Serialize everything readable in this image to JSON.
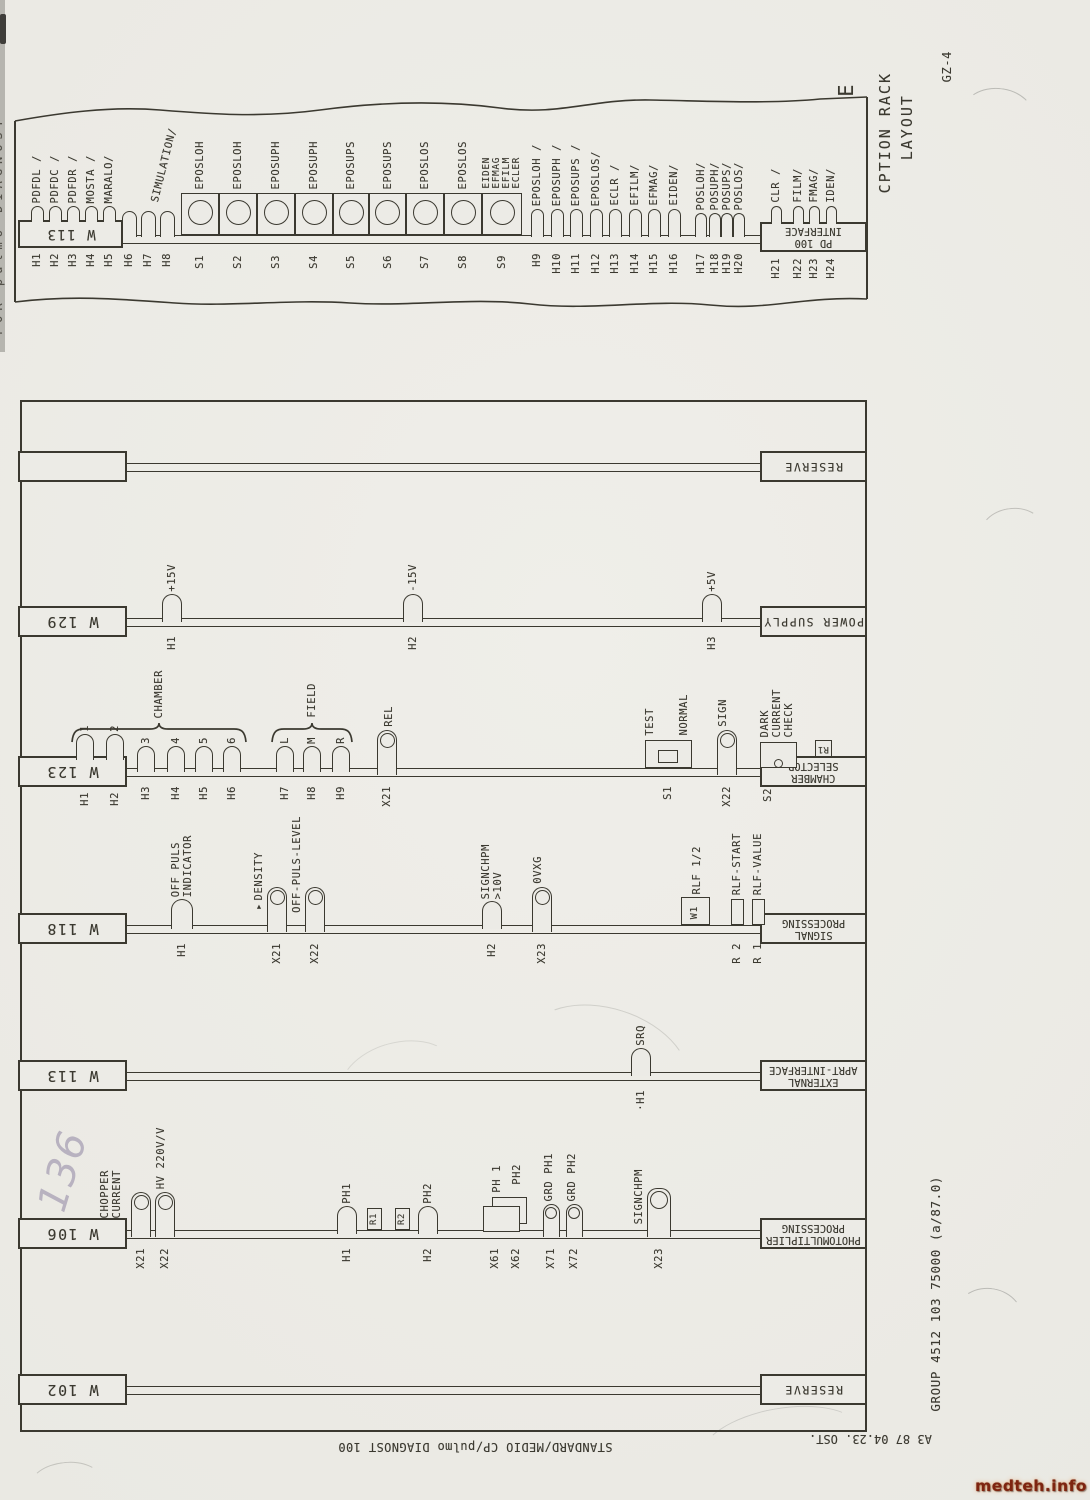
{
  "margin_texts": {
    "sheet_letter": "E",
    "title": "CPTION RACK\n   LAYOUT",
    "sheet_code": "GZ-4",
    "footer_group": "GROUP 4512 103 75000 (a/87.0)",
    "footer_standard": "STANDARD/MEDIO CP/pulmo DIAGNOST 100",
    "footer_sheet": "A3 87 04.23. OST.",
    "left_edge_text": "FOR pulmo DIAGNOST",
    "handwritten_note": "136",
    "watermark": "medteh.info"
  },
  "colors": {
    "ink": "#3b3930",
    "paper": "#ecebe6",
    "pencil": "#b3adbc",
    "watermark": "#7e2410"
  },
  "top_strip": {
    "left_box": "W 113",
    "right_box": "PD 100\nINTERFACE",
    "simulation_label": "SIMULATION/",
    "lamps": [
      {
        "ref": "H1",
        "label": "PDFDL /",
        "x": 37,
        "base": 220,
        "w": 13,
        "h": 14
      },
      {
        "ref": "H2",
        "label": "PDFDC /",
        "x": 55,
        "base": 220,
        "w": 13,
        "h": 14
      },
      {
        "ref": "H3",
        "label": "PDFDR /",
        "x": 73,
        "base": 220,
        "w": 13,
        "h": 14
      },
      {
        "ref": "H4",
        "label": "MOSTA /",
        "x": 91,
        "base": 220,
        "w": 13,
        "h": 14
      },
      {
        "ref": "H5",
        "label": "MARALO/",
        "x": 109,
        "base": 220,
        "w": 13,
        "h": 14
      },
      {
        "ref": "H6",
        "label": "",
        "x": 129,
        "base": 235,
        "w": 15,
        "h": 24
      },
      {
        "ref": "H7",
        "label": "",
        "x": 148,
        "base": 235,
        "w": 15,
        "h": 24
      },
      {
        "ref": "H8",
        "label": "",
        "x": 167,
        "base": 235,
        "w": 15,
        "h": 24
      },
      {
        "ref": "H9",
        "label": "EPOSLOH /",
        "x": 537,
        "base": 235,
        "w": 13,
        "h": 26
      },
      {
        "ref": "H10",
        "label": "EPOSUPH /",
        "x": 557,
        "base": 235,
        "w": 13,
        "h": 26
      },
      {
        "ref": "H11",
        "label": "EPOSUPS /",
        "x": 576,
        "base": 235,
        "w": 13,
        "h": 26
      },
      {
        "ref": "H12",
        "label": "EPOSLOS/",
        "x": 596,
        "base": 235,
        "w": 13,
        "h": 26
      },
      {
        "ref": "H13",
        "label": "ECLR /",
        "x": 615,
        "base": 235,
        "w": 13,
        "h": 26
      },
      {
        "ref": "H14",
        "label": "EFILM/",
        "x": 635,
        "base": 235,
        "w": 13,
        "h": 26
      },
      {
        "ref": "H15",
        "label": "EFMAG/",
        "x": 654,
        "base": 235,
        "w": 13,
        "h": 26
      },
      {
        "ref": "H16",
        "label": "EIDEN/",
        "x": 674,
        "base": 235,
        "w": 13,
        "h": 26
      },
      {
        "ref": "H17",
        "label": "POSLOH/",
        "x": 701,
        "base": 235,
        "w": 12,
        "h": 22
      },
      {
        "ref": "H18",
        "label": "POSUPH/",
        "x": 715,
        "base": 235,
        "w": 12,
        "h": 22
      },
      {
        "ref": "H19",
        "label": "POSUPS/",
        "x": 727,
        "base": 235,
        "w": 12,
        "h": 22
      },
      {
        "ref": "H20",
        "label": "POSLOS/",
        "x": 739,
        "base": 235,
        "w": 12,
        "h": 22
      },
      {
        "ref": "H21",
        "label": "CLR /",
        "x": 776,
        "base": 222,
        "w": 11,
        "h": 16
      },
      {
        "ref": "H22",
        "label": "FILM/",
        "x": 798,
        "base": 222,
        "w": 11,
        "h": 16
      },
      {
        "ref": "H23",
        "label": "FMAG/",
        "x": 814,
        "base": 222,
        "w": 11,
        "h": 16
      },
      {
        "ref": "H24",
        "label": "IDEN/",
        "x": 831,
        "base": 222,
        "w": 11,
        "h": 16
      }
    ],
    "cells": [
      {
        "ref": "S1",
        "label": "EPOSLOH",
        "x": 181,
        "w": 38
      },
      {
        "ref": "S2",
        "label": "EPOSLOH",
        "x": 219,
        "w": 38
      },
      {
        "ref": "S3",
        "label": "EPOSUPH",
        "x": 257,
        "w": 38
      },
      {
        "ref": "S4",
        "label": "EPOSUPH",
        "x": 295,
        "w": 38
      },
      {
        "ref": "S5",
        "label": "EPOSUPS",
        "x": 333,
        "w": 36
      },
      {
        "ref": "S6",
        "label": "EPOSUPS",
        "x": 369,
        "w": 37
      },
      {
        "ref": "S7",
        "label": "EPOSLOS",
        "x": 406,
        "w": 38
      },
      {
        "ref": "S8",
        "label": "EPOSLOS",
        "x": 444,
        "w": 38
      },
      {
        "ref": "S9",
        "label": "EIDEN\nEFMAG\nEFILM\nECLER",
        "x": 482,
        "w": 40
      }
    ]
  },
  "rack": {
    "rows": [
      {
        "id": "reserve-top",
        "bus_y": 463,
        "left_box": "",
        "right_box": "RESERVE",
        "items": []
      },
      {
        "id": "w129",
        "bus_y": 618,
        "left_box": "W 129",
        "right_box": "POWER SUPPLY",
        "items": [
          {
            "kind": "lamp",
            "ref": "H1",
            "label": "+15V",
            "x": 172
          },
          {
            "kind": "lamp",
            "ref": "H2",
            "label": "-15V",
            "x": 413
          },
          {
            "kind": "lamp",
            "ref": "H3",
            "label": "+5V",
            "x": 712
          }
        ]
      },
      {
        "id": "w123",
        "bus_y": 768,
        "left_box": "W 123",
        "right_box": "CHAMBER\nSELECTOR",
        "braces": [
          {
            "label": "CHAMBER",
            "x1": 72,
            "x2": 246,
            "y": 722
          },
          {
            "label": "FIELD",
            "x1": 272,
            "x2": 352,
            "y": 722
          }
        ],
        "items": [
          {
            "kind": "lamp",
            "ref": "H1",
            "label": "1",
            "x": 85,
            "w": 18,
            "h": 24
          },
          {
            "kind": "lamp",
            "ref": "H2",
            "label": "2",
            "x": 115,
            "w": 18,
            "h": 24
          },
          {
            "kind": "lamp",
            "ref": "H3",
            "label": "3",
            "x": 146,
            "w": 18,
            "h": 24
          },
          {
            "kind": "lamp",
            "ref": "H4",
            "label": "4",
            "x": 176,
            "w": 18,
            "h": 24
          },
          {
            "kind": "lamp",
            "ref": "H5",
            "label": "5",
            "x": 204,
            "w": 18,
            "h": 24
          },
          {
            "kind": "lamp",
            "ref": "H6",
            "label": "6",
            "x": 232,
            "w": 18,
            "h": 24
          },
          {
            "kind": "lamp",
            "ref": "H7",
            "label": "L",
            "x": 285,
            "w": 18,
            "h": 24
          },
          {
            "kind": "lamp",
            "ref": "H8",
            "label": "M",
            "x": 312,
            "w": 18,
            "h": 24
          },
          {
            "kind": "lamp",
            "ref": "H9",
            "label": "R",
            "x": 341,
            "w": 18,
            "h": 24
          },
          {
            "kind": "connector",
            "ref": "X21",
            "label": "REL",
            "x": 387,
            "ldx": 2
          },
          {
            "kind": "slide-switch",
            "ref": "S1",
            "labels": [
              "TEST",
              "NORMAL"
            ],
            "x": 645,
            "w": 47
          },
          {
            "kind": "connector",
            "ref": "X22",
            "label": "SIGN",
            "x": 727,
            "ldx": -4
          },
          {
            "kind": "module",
            "ref": "S2",
            "label": "DARK\nCURRENT\nCHECK",
            "x": 760,
            "w": 37
          },
          {
            "kind": "rbox-flip",
            "text": "R1",
            "x": 815
          }
        ]
      },
      {
        "id": "w118",
        "bus_y": 925,
        "left_box": "W 118",
        "right_box": "SIGNAL\nPROCESSING",
        "items": [
          {
            "kind": "lamp",
            "ref": "H1",
            "label": "OFF PULS\nINDICATOR",
            "x": 182,
            "w": 22,
            "h": 28
          },
          {
            "kind": "connector",
            "ref": "X21",
            "label": "▾DENSITY",
            "x": 277,
            "side": "left"
          },
          {
            "kind": "connector",
            "ref": "X22",
            "label": "OFF-PULS-LEVEL",
            "x": 315,
            "side": "left"
          },
          {
            "kind": "lamp",
            "ref": "H2",
            "label": "SIGNCHPM\n>10V",
            "x": 492
          },
          {
            "kind": "connector",
            "ref": "X23",
            "label": "0VXG",
            "x": 542,
            "ldx": -4
          },
          {
            "kind": "wbox",
            "text": "W1",
            "label": "RLF 1/2",
            "x": 695
          },
          {
            "kind": "rbox",
            "ref": "R 2",
            "label": "RLF-START",
            "x": 737
          },
          {
            "kind": "rbox",
            "ref": "R 1",
            "label": "RLF-VALUE",
            "x": 758
          }
        ]
      },
      {
        "id": "w113",
        "bus_y": 1072,
        "left_box": "W 113",
        "right_box": "EXTERNAL\nAPRT-INTERFACE",
        "items": [
          {
            "kind": "lamp",
            "ref": "·H1",
            "label": "SRQ",
            "x": 641
          }
        ]
      },
      {
        "id": "w106",
        "bus_y": 1230,
        "left_box": "W 106",
        "right_box": "PHOTOMULTIPLIER\nPROCESSING",
        "items": [
          {
            "kind": "connector",
            "ref": "X21",
            "label": "CHOPPER\nCURRENT",
            "x": 141,
            "side": "left"
          },
          {
            "kind": "connector",
            "ref": "X22",
            "label": "HV 220V/V",
            "x": 165,
            "ldx": -4
          },
          {
            "kind": "lamp",
            "ref": "H1",
            "label": "PH1",
            "x": 347
          },
          {
            "kind": "rbox-vtext",
            "text": "R1",
            "x": 374
          },
          {
            "kind": "rbox-vtext",
            "text": "R2",
            "x": 402
          },
          {
            "kind": "lamp",
            "ref": "H2",
            "label": "PH2",
            "x": 428
          },
          {
            "kind": "dualrect",
            "refs": [
              "X61",
              "X62"
            ],
            "labels": [
              "PH 1",
              "PH2"
            ],
            "x": 483
          },
          {
            "kind": "connector-sm",
            "ref": "X71",
            "label": "GRD PH1",
            "x": 551,
            "ldx": -2
          },
          {
            "kind": "connector-sm",
            "ref": "X72",
            "label": "GRD PH2",
            "x": 574,
            "ldx": -2
          },
          {
            "kind": "connector-big",
            "ref": "X23",
            "label": "SIGNCHPM",
            "x": 659,
            "side": "left"
          }
        ]
      },
      {
        "id": "w102",
        "bus_y": 1386,
        "left_box": "W 102",
        "right_box": "RESERVE",
        "items": []
      }
    ]
  }
}
